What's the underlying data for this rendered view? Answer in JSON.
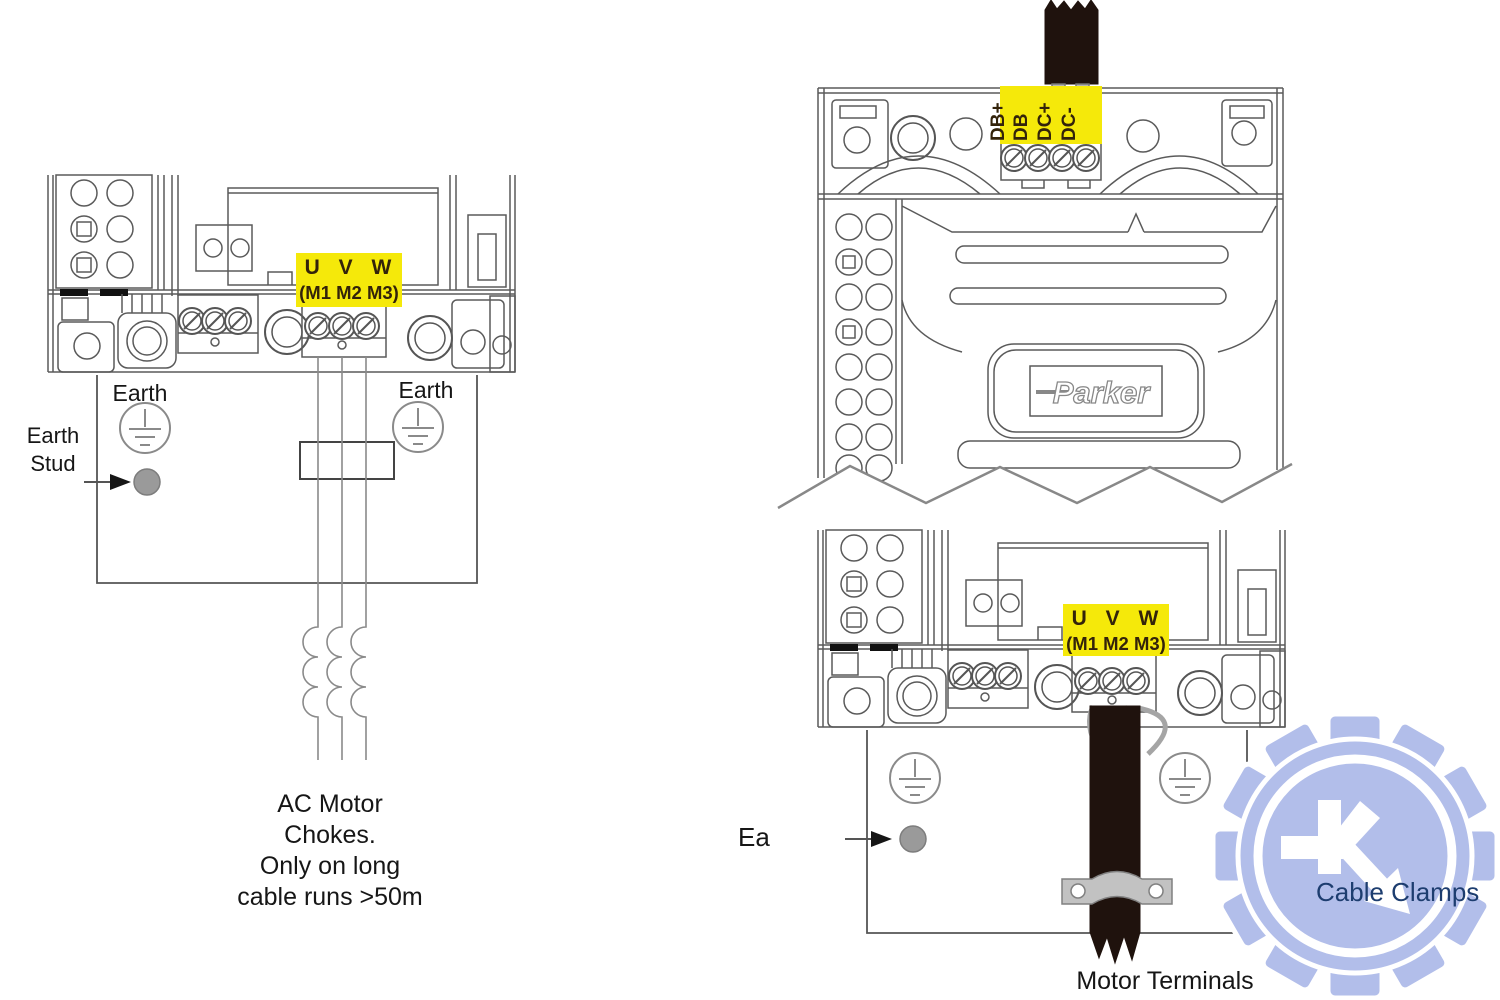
{
  "left_diagram": {
    "terminal_label": {
      "line1": "U V W",
      "line2": "(M1 M2 M3)"
    },
    "earth_left_label": "Earth",
    "earth_right_label": "Earth",
    "earth_stud_lines": [
      "Earth",
      "Stud"
    ],
    "chokes_note_lines": [
      "AC Motor",
      "Chokes.",
      "Only on long",
      "cable runs >50m"
    ]
  },
  "top_right_diagram": {
    "dc_terminal_labels": [
      "DB+",
      "DB",
      "DC+",
      "DC-"
    ],
    "brand_logo_text": "Parker"
  },
  "bottom_right_diagram": {
    "terminal_label": {
      "line1": "U V W",
      "line2": "(M1 M2 M3)"
    },
    "earth_stud_label": "Ea",
    "motor_terminals_label": "Motor Terminals"
  },
  "watermark": {
    "label": "Cable Clamps"
  },
  "colors": {
    "terminal_label_bg": "#f5e90a",
    "terminal_label_text": "#33230a",
    "line_art": "#5a5a5a",
    "cable_black": "#1f120d",
    "clamp_gray": "#c2c2c2",
    "stud_gray": "#9a9a9a",
    "watermark_gear": "#b2beea",
    "watermark_text": "#1d3d6f"
  }
}
